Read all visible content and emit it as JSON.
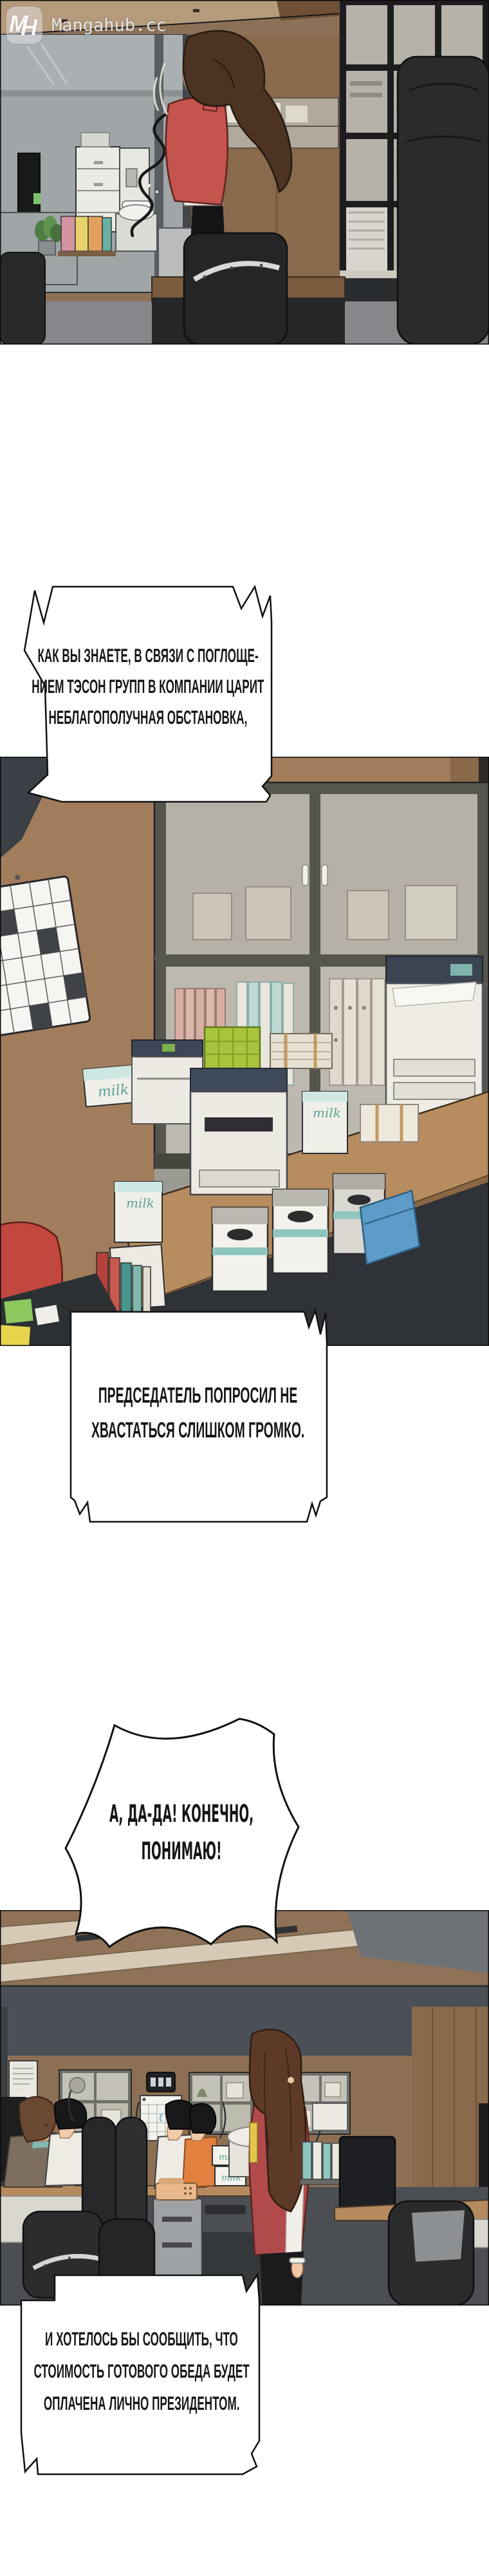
{
  "watermark": {
    "monogram_m": "M",
    "monogram_h": "H",
    "site": "Mangahub.cc"
  },
  "bubbles": {
    "b1": {
      "lines": [
        "КАК ВЫ ЗНАЕТЕ, В СВЯЗИ С ПОГЛОЩЕ-",
        "НИЕМ ТЭСОН ГРУПП В КОМПАНИИ ЦАРИТ",
        "НЕБЛАГОПОЛУЧНАЯ ОБСТАНОВКА,"
      ]
    },
    "b2": {
      "lines": [
        "ПРЕДСЕДАТЕЛЬ ПОПРОСИЛ НЕ",
        "ХВАСТАТЬСЯ СЛИШКОМ ГРОМКО."
      ]
    },
    "b3": {
      "lines": [
        "А, ДА-ДА! КОНЕЧНО,",
        "ПОНИМАЮ!"
      ]
    },
    "b4": {
      "lines": [
        "И ХОТЕЛОСЬ БЫ СООБЩИТЬ, ЧТО",
        "СТОИМОСТЬ ГОТОВОГО ОБЕДА БУДЕТ",
        "ОПЛАЧЕНА ЛИЧНО ПРЕЗИДЕНТОМ."
      ]
    }
  },
  "props": {
    "milk_label": "milk"
  },
  "palette": {
    "accent_red": "#c0504c",
    "wood": "#a27d5c",
    "dark_wall": "#4b4f58",
    "chair_black": "#2a2b2d",
    "teal": "#8fc6bf",
    "outline": "#17181a"
  }
}
